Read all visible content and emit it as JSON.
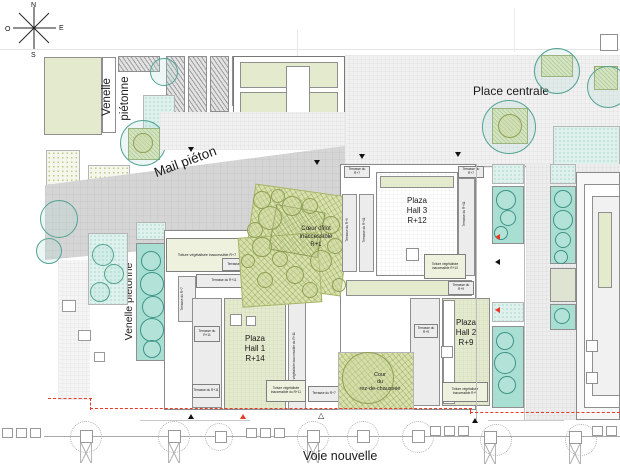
{
  "compass": {
    "north": "N",
    "south": "S",
    "east": "E",
    "west": "O"
  },
  "areas": {
    "venelle_top_l1": "Venelle",
    "venelle_top_l2": "piétonne",
    "venelle_left": "Venelle piétonne",
    "mail_pieton": "Mail piéton",
    "place_centrale": "Place centrale",
    "voie_nouvelle": "Voie nouvelle"
  },
  "coeur_ilot": {
    "l1": "Cœur d'îlot",
    "l2": "inaccessible",
    "l3": "R+1"
  },
  "cour_rdc": {
    "l1": "Cour",
    "l2": "du",
    "l3": "rez-de-chaussée"
  },
  "halls": {
    "hall1": {
      "l1": "Plaza",
      "l2": "Hall 1",
      "l3": "R+14"
    },
    "hall2": {
      "l1": "Plaza",
      "l2": "Hall 2",
      "l3": "R+9"
    },
    "hall3": {
      "l1": "Plaza",
      "l2": "Hall 3",
      "l3": "R+12"
    }
  },
  "roofs": {
    "terrasse_r7": "Terrasse du R+7",
    "terrasse_r9": "Terrasse du R+9",
    "terrasse_r11": "Terrasse du R+11",
    "toiture_r7": "Toiture végétalisée inaccessible R+7",
    "toiture_r9": "Toiture végétalisée inaccessible R+9",
    "toiture_r10": "Toiture végétalisée inaccessible R+10",
    "toiture_r11": "Toiture végétalisée inaccessible du R+11"
  },
  "markers": {
    "open_triangle": "△"
  },
  "colors": {
    "boundary_red": "#e63a28",
    "teal_planter": "#a9ded3",
    "pale_green_roof": "#e4eacd",
    "garden_green": "#d9e2ad",
    "plaza_gray": "#d5d5d5"
  }
}
